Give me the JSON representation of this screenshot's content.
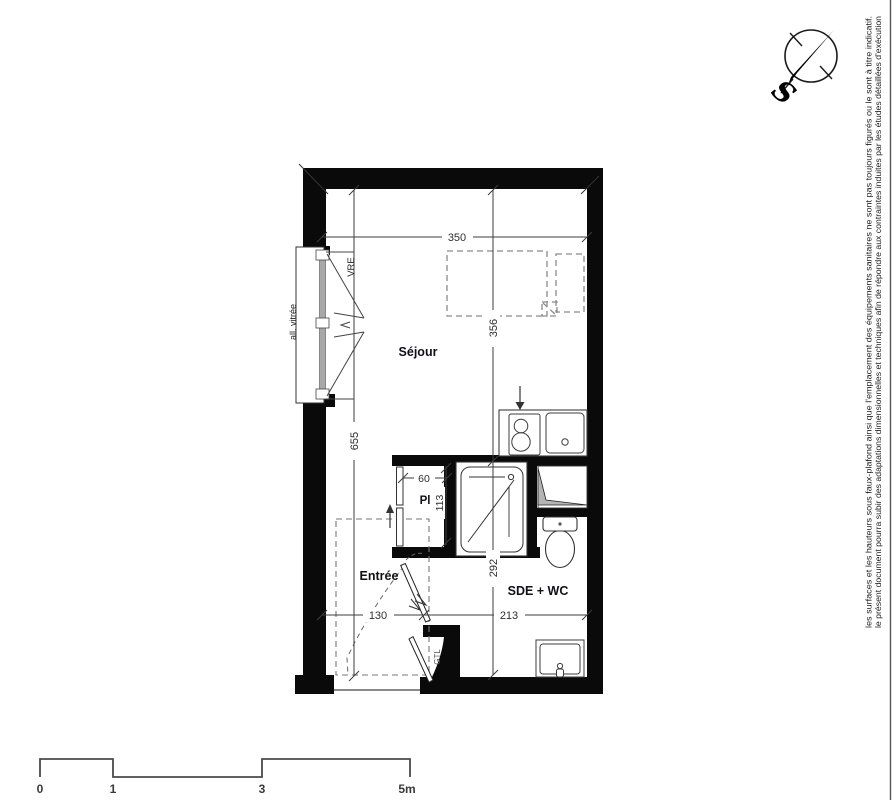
{
  "page": {
    "background": "#ffffff"
  },
  "compass": {
    "south_label": "S"
  },
  "side_note": {
    "line1": "le présent document pourra subir des adaptations dimensionnelles et techniques afin de répondre aux contraintes induites par les études détaillées d'exécution",
    "line2": "les surfaces et les hauteurs sous faux-plafond ainsi que l'emplacement des équipements sanitaires ne sont pas toujours figurés ou le sont à titre indicatif."
  },
  "plan": {
    "rooms": [
      {
        "name": "Séjour"
      },
      {
        "name": "Pl"
      },
      {
        "name": "Entrée"
      },
      {
        "name": "SDE + WC"
      }
    ],
    "labels": {
      "glazed_sill": "all. vitrée",
      "roller_shutter": "VRE",
      "utility_duct": "GTL"
    },
    "dimensions_cm": {
      "sejour_width": "350",
      "sejour_depth": "356",
      "total_depth": "655",
      "closet_width": "60",
      "closet_depth": "113",
      "sde_depth": "292",
      "entree_width": "130",
      "sde_width": "213"
    },
    "colors": {
      "wall": "#0a0a0a",
      "line": "#3d3d3d",
      "furniture_dashed": "#8a8a8a",
      "glazing": "#a8a8a8",
      "duct_fill": "#b4b4b4"
    }
  },
  "scale_bar": {
    "labels": [
      "0",
      "1",
      "3",
      "5m"
    ]
  }
}
